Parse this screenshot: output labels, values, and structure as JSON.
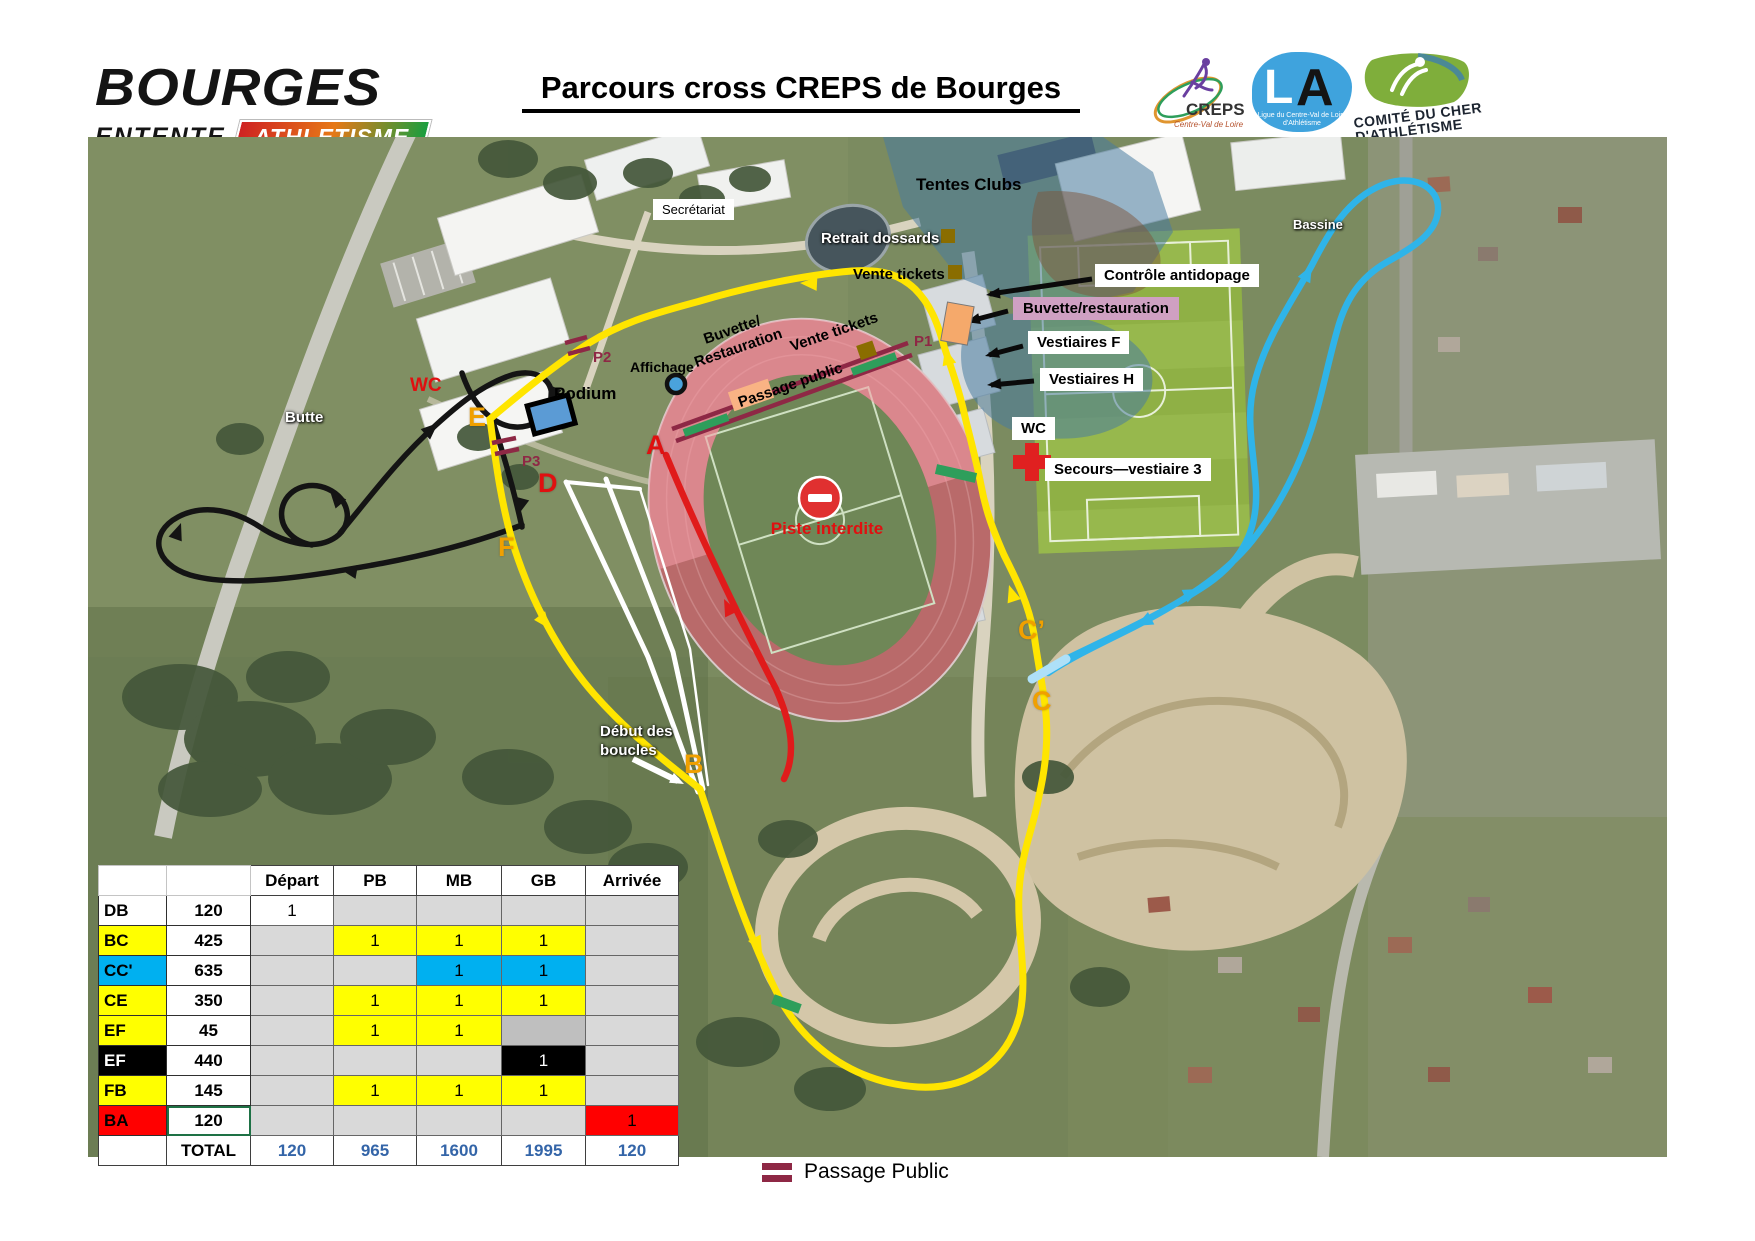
{
  "header": {
    "club": {
      "name": "BOURGES",
      "line2": "ENTENTE",
      "line3": "ATHLETISME"
    },
    "title": "Parcours cross CREPS de Bourges",
    "logos": {
      "creps": {
        "name": "CREPS",
        "subtitle": "Centre-Val de Loire"
      },
      "lca": {
        "l": "L",
        "a": "A",
        "subtitle1": "Ligue du Centre-Val de Loire",
        "subtitle2": "d'Athlétisme"
      },
      "comite": {
        "line1": "COMITÉ DU CHER",
        "line2": "D'ATHLÉTISME"
      }
    }
  },
  "map": {
    "labels": {
      "secretariat": "Secrétariat",
      "tentes_clubs": "Tentes Clubs",
      "retrait_dossards": "Retrait dossards",
      "vente_tickets": "Vente tickets",
      "controle_antidopage": "Contrôle antidopage",
      "buvette_restauration": "Buvette/restauration",
      "vestiaires_f": "Vestiaires F",
      "vestiaires_h": "Vestiaires H",
      "wc": "WC",
      "secours": "Secours—vestiaire 3",
      "bassine": "Bassine",
      "butte": "Butte",
      "wc_red": "WC",
      "affichage": "Affichage",
      "podium": "Podium",
      "buvette_rot_1": "Buvette/",
      "buvette_rot_2": "Restauration",
      "vente_rot": "Vente tickets",
      "passage_rot": "Passage public",
      "piste_interdite": "Piste interdite",
      "debut_1": "Début des",
      "debut_2": "boucles"
    },
    "letters": {
      "a": "A",
      "b": "B",
      "c": "C",
      "c2": "C’",
      "d": "D",
      "e": "E",
      "f": "F"
    },
    "p_markers": {
      "p1": "P1",
      "p2": "P2",
      "p3": "P3"
    },
    "route_colors": {
      "yellow": "#ffe500",
      "black": "#141414",
      "blue": "#2fb4e9",
      "red": "#e01b1b",
      "white": "#ffffff",
      "passage": "#8e2845",
      "green_mark": "#2e9e5b"
    }
  },
  "table": {
    "headers": [
      "Départ",
      "PB",
      "MB",
      "GB",
      "Arrivée"
    ],
    "rows": [
      {
        "label": "DB",
        "label_bg": "white",
        "distance": "120",
        "selected": false,
        "cells": [
          {
            "v": "1",
            "bg": "white"
          },
          {
            "v": "",
            "bg": "gray"
          },
          {
            "v": "",
            "bg": "gray"
          },
          {
            "v": "",
            "bg": "gray"
          },
          {
            "v": "",
            "bg": "gray"
          }
        ]
      },
      {
        "label": "BC",
        "label_bg": "yellow",
        "distance": "425",
        "selected": false,
        "cells": [
          {
            "v": "",
            "bg": "gray"
          },
          {
            "v": "1",
            "bg": "yellow"
          },
          {
            "v": "1",
            "bg": "yellow"
          },
          {
            "v": "1",
            "bg": "yellow"
          },
          {
            "v": "",
            "bg": "gray"
          }
        ]
      },
      {
        "label": "CC'",
        "label_bg": "cyan",
        "distance": "635",
        "selected": false,
        "cells": [
          {
            "v": "",
            "bg": "gray"
          },
          {
            "v": "",
            "bg": "gray"
          },
          {
            "v": "1",
            "bg": "cyan"
          },
          {
            "v": "1",
            "bg": "cyan"
          },
          {
            "v": "",
            "bg": "gray"
          }
        ]
      },
      {
        "label": "CE",
        "label_bg": "yellow",
        "distance": "350",
        "selected": false,
        "cells": [
          {
            "v": "",
            "bg": "gray"
          },
          {
            "v": "1",
            "bg": "yellow"
          },
          {
            "v": "1",
            "bg": "yellow"
          },
          {
            "v": "1",
            "bg": "yellow"
          },
          {
            "v": "",
            "bg": "gray"
          }
        ]
      },
      {
        "label": "EF",
        "label_bg": "yellow",
        "distance": "45",
        "selected": false,
        "cells": [
          {
            "v": "",
            "bg": "gray"
          },
          {
            "v": "1",
            "bg": "yellow"
          },
          {
            "v": "1",
            "bg": "yellow"
          },
          {
            "v": "",
            "bg": "darkgray"
          },
          {
            "v": "",
            "bg": "gray"
          }
        ]
      },
      {
        "label": "EF",
        "label_bg": "black",
        "distance": "440",
        "selected": false,
        "cells": [
          {
            "v": "",
            "bg": "gray"
          },
          {
            "v": "",
            "bg": "gray"
          },
          {
            "v": "",
            "bg": "gray"
          },
          {
            "v": "1",
            "bg": "black"
          },
          {
            "v": "",
            "bg": "gray"
          }
        ]
      },
      {
        "label": "FB",
        "label_bg": "yellow",
        "distance": "145",
        "selected": false,
        "cells": [
          {
            "v": "",
            "bg": "gray"
          },
          {
            "v": "1",
            "bg": "yellow"
          },
          {
            "v": "1",
            "bg": "yellow"
          },
          {
            "v": "1",
            "bg": "yellow"
          },
          {
            "v": "",
            "bg": "gray"
          }
        ]
      },
      {
        "label": "BA",
        "label_bg": "red",
        "distance": "120",
        "selected": true,
        "cells": [
          {
            "v": "",
            "bg": "gray"
          },
          {
            "v": "",
            "bg": "gray"
          },
          {
            "v": "",
            "bg": "gray"
          },
          {
            "v": "",
            "bg": "gray"
          },
          {
            "v": "1",
            "bg": "red"
          }
        ]
      }
    ],
    "total": {
      "label": "TOTAL",
      "values": [
        "120",
        "965",
        "1600",
        "1995",
        "120"
      ]
    }
  },
  "legend": {
    "passage_public": "Passage Public"
  }
}
